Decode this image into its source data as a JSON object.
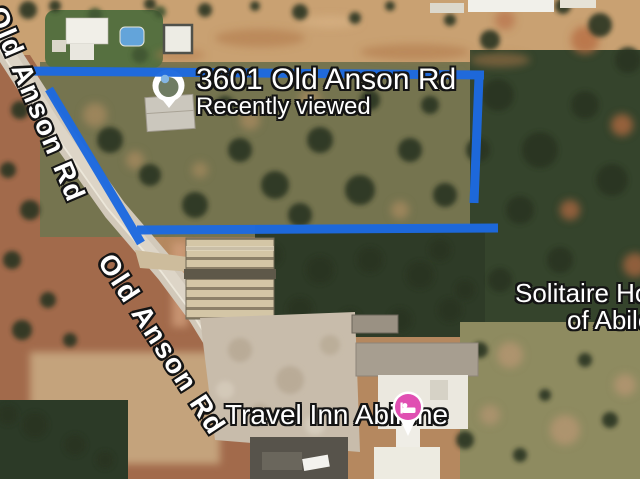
{
  "map": {
    "marker": {
      "title": "3601 Old Anson Rd",
      "status": "Recently viewed",
      "icon": "recently-viewed-pin"
    },
    "roads": [
      {
        "label": "Old Anson Rd"
      },
      {
        "label": "Old Anson Rd"
      }
    ],
    "pois": [
      {
        "label": "Travel Inn Abilene",
        "icon": "lodging-pin",
        "icon_color": "#e04fb2"
      },
      {
        "label_line1": "Solitaire Homes",
        "label_line2": "of Abilene"
      }
    ],
    "boundary": {
      "color": "#1d6ae0"
    },
    "colors": {
      "boundary_blue": "#1d6ae0",
      "lodging_pin_pink": "#e04fb2",
      "recently_viewed_inner": "#6f7c63",
      "recently_viewed_dot": "#84b6e3"
    }
  }
}
